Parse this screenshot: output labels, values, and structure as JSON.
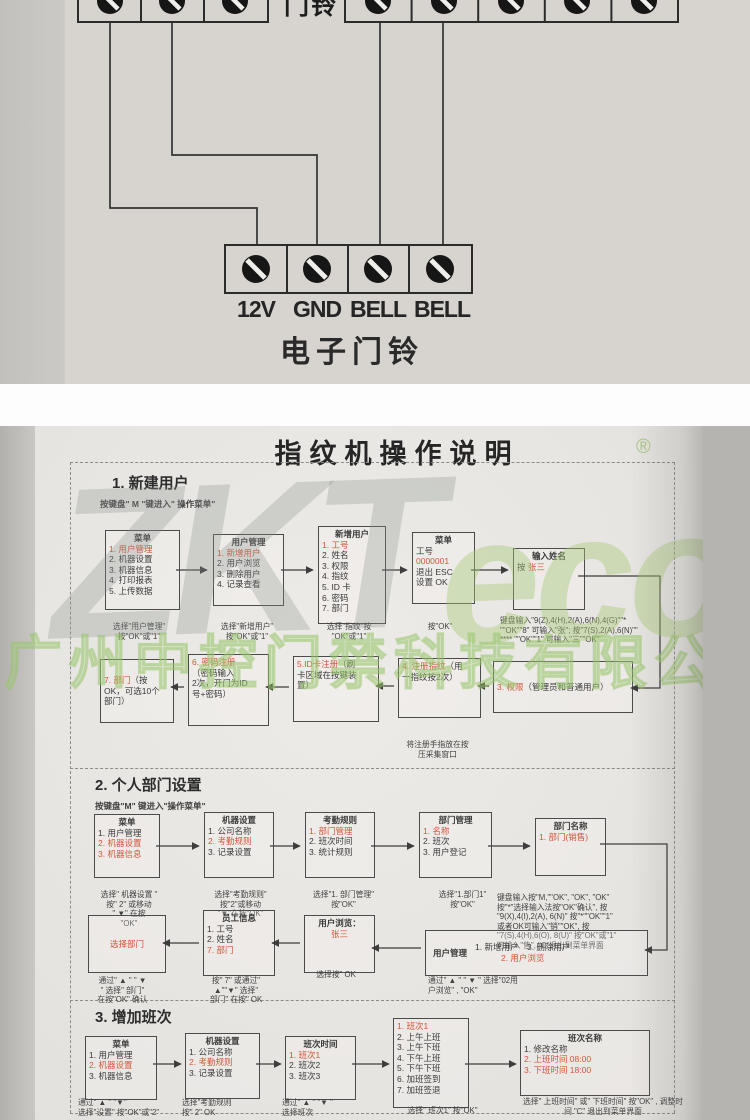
{
  "top": {
    "partial_device_label": "门铃",
    "terminals": [
      "12V",
      "GND",
      "BELL",
      "BELL"
    ],
    "caption": "电子门铃"
  },
  "sheet": {
    "title": "指纹机操作说明",
    "reg_mark": "®",
    "watermark": {
      "gray": "ZKT",
      "green": "eco",
      "company": "广州中控门禁科技有限公司"
    },
    "s1": {
      "heading": "1. 新建用户",
      "subtitle": "按键盘\" M \"键进入\" 操作菜单\"",
      "b1": {
        "lines": [
          "^菜单",
          "«1. 用户管理»",
          "2. 机器设置",
          "3. 机器信息",
          "4. 打印报表",
          "5. 上传数据"
        ]
      },
      "b2": {
        "lines": [
          "^用户管理",
          "«1. 新增用户»",
          "2. 用户浏览",
          "3. 删除用户",
          "4. 记录查看"
        ]
      },
      "b3": {
        "lines": [
          "^新增用户",
          "«1. 工号»",
          "2. 姓名",
          "3. 权限",
          "4. 指纹",
          "5. ID 卡",
          "6. 密码",
          "7. 部门"
        ]
      },
      "b4": {
        "lines": [
          "^菜单",
          "工号",
          "«0000001»",
          "退出 ESC",
          "设置 OK"
        ]
      },
      "b5": {
        "lines": [
          "^输入姓名",
          "按 «张三»"
        ]
      },
      "c1": "选择\"用户管理\"\n按\"OK\"或\"1\"",
      "c2": "选择\"新增用户\"\n按\"OK\"或\"1\"",
      "c3": "选择\"指纹\"按\n\"OK\"或\"1\"",
      "c4": "按\"OK\"",
      "c5": "键盘输入\"9(Z),4(H),2(A),6(N),4(G)\"\"*\n\"\"OK\"\"8\" 可输入\"张\"; 按\"7(S),2(A),6(N)\"\"\n**** \"\"OK\"\"1\" 可输入\"三\"\"OK\"",
      "r1": {
        "lines": [
          "«3. 权限»（管理员和普通用户）"
        ]
      },
      "r2": {
        "lines": [
          "«4. 注册指纹»（用",
          "一指纹按2次）"
        ]
      },
      "r3": {
        "lines": [
          "«5.ID卡注册»（刷",
          "卡区域在按键装",
          "置）"
        ]
      },
      "r4": {
        "lines": [
          "«6. 密码注册»",
          "（密码输入",
          "2次，开门为ID",
          "号+密码）"
        ]
      },
      "r5": {
        "lines": [
          "«7. 部门»（按",
          "OK，可选10个",
          "部门）"
        ]
      },
      "c_fingerprint": "将注册手指放在按\n压采集窗口"
    },
    "s2": {
      "heading": "2. 个人部门设置",
      "subtitle": "按键盘\"M\" 键进入\"操作菜单\"",
      "b1": {
        "lines": [
          "^菜单",
          "1. 用户管理",
          "«2. 机器设置»",
          "«3. 机器信息»"
        ]
      },
      "b2": {
        "lines": [
          "^机器设置",
          "1. 公司名称",
          "«2. 考勤规则»",
          "3. 记录设置"
        ]
      },
      "b3": {
        "lines": [
          "^考勤规则",
          "«1. 部门管理»",
          "2. 班次时间",
          "3. 统计规则"
        ]
      },
      "b4": {
        "lines": [
          "^部门管理",
          "«1. 名称»",
          "2. 班次",
          "3. 用户登记"
        ]
      },
      "b5": {
        "lines": [
          "^部门名称",
          "«1. 部门(销售)»"
        ]
      },
      "c1": "选择\" 机器设置 \"\n按\" 2\" 或移动\n\" ▼\" 在按\n\"OK\"",
      "c2": "选择\"考勤规则\"\n按\"2\"或移动\n\"▼\"在按\"OK\"",
      "c3": "选择\"1. 部门管理\"\n按\"OK\"",
      "c4": "选择\"1.部门1\"\n按\"OK\"",
      "c5": "键盘输入按\"M,\"\"OK\", \"OK\", \"OK\"\n按\"*\"选择输入法按\"OK\"确认\", 按\n\"9(X),4(I),2(A), 6(N)\" 按\"*\"\"OK\"\"1\"\n或者OK可输入\"销\"\"OK\", 按\n\"7(S),4(H),6(O), 8(U)\" 按\"OK\"或\"1\"\n可输入\"售\", \"C\"退出到菜单界面",
      "w1_label": "用户管理",
      "w1": {
        "lines": [
          "1. 新增用户　3. 删除用户",
          "~«2. 用户浏览»"
        ]
      },
      "w2": {
        "lines": [
          "^用户浏览：",
          "~«张三»"
        ]
      },
      "w3": {
        "lines": [
          "^员工信息",
          "1. 工号",
          "2. 姓名",
          "«7. 部门»"
        ]
      },
      "w4": {
        "lines": [
          "~«选择部门»"
        ]
      },
      "cw1": "通过\" ▲ \" \" ▼ \" 选择\"02用\n户浏览\" , \"OK\"",
      "cw2": "选择按\" OK",
      "cw3": "按\" 7\" 或通过\"\n▲\"\"▼\" 选择\"\n部门\" 在按\" OK",
      "cw4": "通过\" ▲ \" \" ▼\n\" 选择\" 部门\"\n在按\"OK\" 确认"
    },
    "s3": {
      "heading": "3. 增加班次",
      "b1": {
        "lines": [
          "^菜单",
          "1. 用户管理",
          "«2. 机器设置»",
          "3. 机器信息"
        ]
      },
      "b2": {
        "lines": [
          "^机器设置",
          "1. 公司名称",
          "«2. 考勤规则»",
          "3. 记录设置"
        ]
      },
      "b3": {
        "lines": [
          "^班次时间",
          "«1. 班次1»",
          "2. 班次2",
          "3. 班次3"
        ]
      },
      "b4": {
        "lines": [
          "«1. 班次1»",
          "2. 上午上班",
          "3. 上午下班",
          "4. 下午上班",
          "5. 下午下班",
          "6. 加班签到",
          "7. 加班签退"
        ]
      },
      "b5": {
        "lines": [
          "^班次名称",
          "1. 修改名称",
          "«2. 上班时间 08:00»",
          "«3. 下班时间 18:00»"
        ]
      },
      "c1": "通过\" ▲ \" \"▼\"\n选择\"设置\" 按\"OK\"或\"2\"",
      "c2": "选择\"考勤规则\n按\" 2\" OK",
      "c3": "通过\" ▲ \" \"▼ \"\n选择班次",
      "c4": "选择\" 班次1\" 按\"OK\"",
      "c5": "选择\" 上班时间\" 或\" 下班时间\" 按\"OK\" , 调整时\n间 \"C\" 退出到菜单界面"
    }
  },
  "colors": {
    "red": "#d2553c",
    "green_watermark": "#a8c97d",
    "paper": "#e7e5e1"
  }
}
